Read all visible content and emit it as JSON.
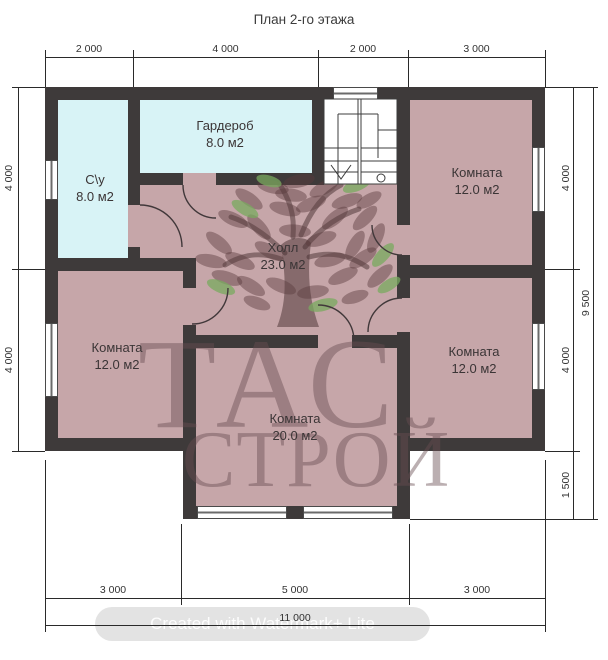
{
  "title": "План 2-го этажа",
  "rooms": {
    "su": {
      "name": "С\\у",
      "area": "8.0 м2"
    },
    "wardrobe": {
      "name": "Гардероб",
      "area": "8.0 м2"
    },
    "hall": {
      "name": "Холл",
      "area": "23.0 м2"
    },
    "room_tr": {
      "name": "Комната",
      "area": "12.0 м2"
    },
    "room_bl": {
      "name": "Комната",
      "area": "12.0 м2"
    },
    "room_br": {
      "name": "Комната",
      "area": "12.0 м2"
    },
    "room_bc": {
      "name": "Комната",
      "area": "20.0 м2"
    }
  },
  "dimensions": {
    "top": [
      "2 000",
      "4 000",
      "2 000",
      "3 000"
    ],
    "bottom": [
      "3 000",
      "5 000",
      "3 000"
    ],
    "bottom_total": "11 000",
    "left": [
      "4 000",
      "4 000"
    ],
    "right": [
      "4 000",
      "4 000",
      "1 500"
    ],
    "right_total": "9 500"
  },
  "watermark": {
    "logo_line1": "ТАС",
    "logo_line2": "СТРОЙ",
    "credit": "Created with Watermark+ Lite"
  },
  "colors": {
    "wall": "#3e3a3a",
    "room_pink": "#c6a6a9",
    "room_cyan": "#d8f3f6",
    "leaf_green": "#8fb97f"
  }
}
